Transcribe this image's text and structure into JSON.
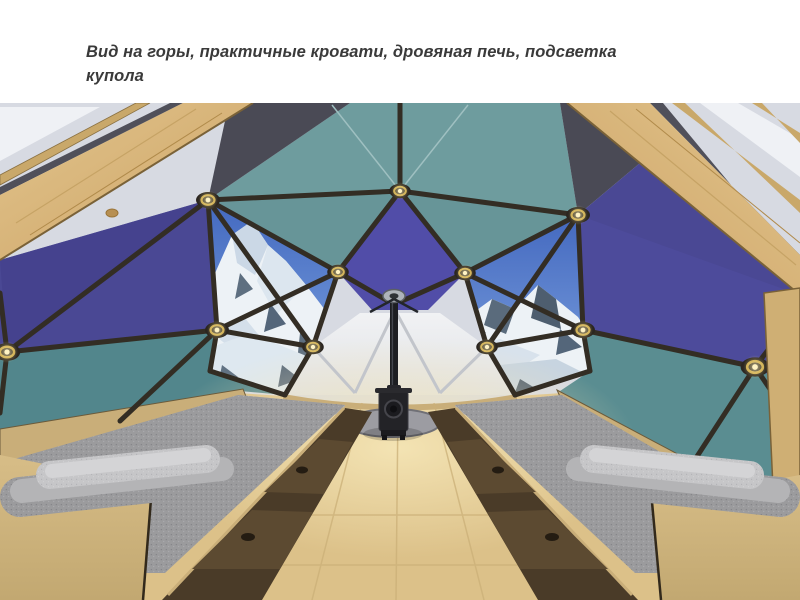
{
  "slide": {
    "caption": {
      "lines": [
        "Вид на горы, практичные кровати, дровяная печь, подсветка",
        "купола"
      ],
      "full_text": "Вид на горы, практичные кровати, дровяная печь, подсветка купола",
      "color": "#3A3A3A"
    }
  },
  "scene": {
    "type": "3d-render",
    "description": "Интерьер геодезического купола: прозрачные панели с видом на заснеженные горы, две кровати с ящиками, дровяная печь в центре, светильники в узлах купола"
  },
  "palette": {
    "caption_text": "#3A3A3A",
    "slide_background": "#FFFFFF",
    "teal_top": "#6E9C9E",
    "teal_mid": "#679598",
    "teal_lower_left": "#52868C",
    "teal_lower_right": "#5A8D91",
    "navy_panel": "#4A4894",
    "purple_panel": "#514DA8",
    "sky_blue": "#4A74C8",
    "snow_white": "#EDF2F6",
    "rock_gray": "#5A6B7C",
    "strut_dark": "#332D24",
    "hub_gold": "#C9A84C",
    "hub_light": "#FFF3C4",
    "beam_wood": "#D8B87E",
    "exterior_gray": "#D7DAE2",
    "white_panel": "#ECEDEF",
    "floor_wood": "#DCC189",
    "floor_glow": "#F6E7B8",
    "bed_wood": "#CDB27E",
    "drawer_dark": "#4A3B28",
    "drawer_face": "#5C4A31",
    "mattress_gray": "#9B9B9D",
    "bolster_gray": "#C6C6C8",
    "hearth_gray": "#9C9CA2",
    "stove_black": "#232327",
    "pipe_black": "#1D1E22"
  }
}
